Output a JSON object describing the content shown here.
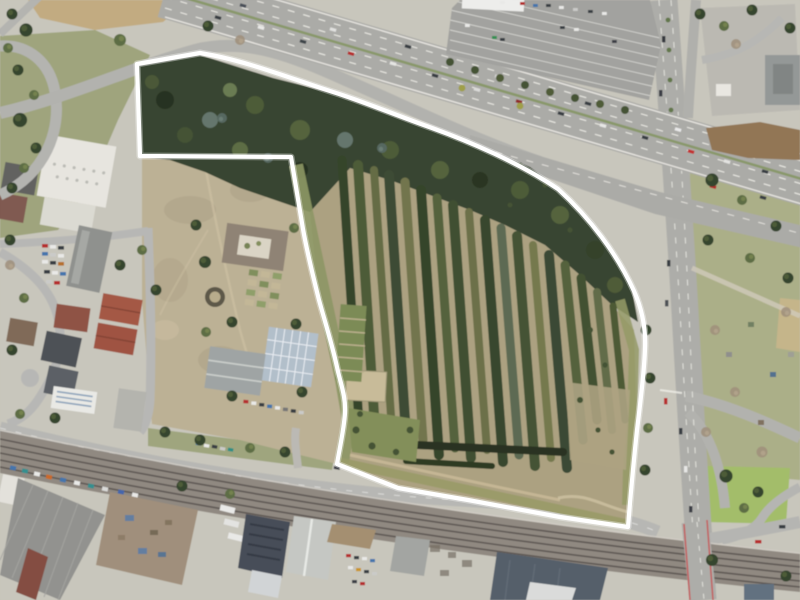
{
  "scene": {
    "type": "aerial-photograph",
    "description": "Aerial orthophoto of an urban development site outlined with a thick white boundary. Inside the boundary: a dense woodland strip along the north edge and long rows of a tree nursery. Excluded notch at the west contains a brownfield and a garden centre. A multi-lane highway crosses the top, a north-south arterial road with a railway overpass runs on the right, a multi-track railway crosses the bottom, and industrial buildings line the south edge.",
    "width": 800,
    "height": 600
  },
  "site_boundary": {
    "color": "#ffffff",
    "stroke_width": "4.2",
    "path": "M137,64 L200,53 C245,60 295,80 333,92 C365,102 398,116 432,128 C468,141 520,163 558,189 C590,218 617,254 634,291 C642,309 646,328 645,349 C644,376 640,405 637,430 C634,458 631,490 628,527 L560,517 L468,500 L398,488 L337,464 C340,446 344,429 345,413 C346,396 340,382 337,367 C332,344 325,322 319,300 C313,276 307,252 303,229 L291,157 L140,156 Z"
  },
  "palette": {
    "urban_ground": "#c6c3b9",
    "asphalt_highway": "#a7a7a3",
    "asphalt_street": "#b4b4b0",
    "lane_marking": "#efeee8",
    "woodland_dark": "#2f3c25",
    "nursery_row_dark": "#2c3a21",
    "nursery_soil": "#a89c7b",
    "brownfield_tan": "#b9ad90",
    "grass_green": "#8f9a66",
    "bright_grass": "#9fba62",
    "rail_ballast": "#8b837b",
    "rail_track": "#57514b",
    "pond_brown": "#8d6f4c",
    "red_roof": "#a0503c",
    "white_roof": "#e8e6e0",
    "dark_roof": "#4c5662",
    "bridge_railing_red": "#c05858"
  },
  "landmarks": [
    {
      "id": "site-boundary",
      "label": "white site boundary outline"
    },
    {
      "id": "highway",
      "label": "multi-lane highway crossing the top, diagonal"
    },
    {
      "id": "highway-ramp",
      "label": "curved slip road along the north site edge"
    },
    {
      "id": "arterial-road",
      "label": "north-south arterial with median trees and rail overpass"
    },
    {
      "id": "railway",
      "label": "multi-track railway crossing the lower area"
    },
    {
      "id": "street-north-of-railway",
      "label": "local street parallel to the railway"
    },
    {
      "id": "parking-lot",
      "label": "large marked parking lot, top centre"
    },
    {
      "id": "woodland",
      "label": "dense woodland strip inside the north boundary"
    },
    {
      "id": "tree-nursery",
      "label": "parallel tree-nursery rows inside the site"
    },
    {
      "id": "brownfield",
      "label": "bare brownfield in the excluded western notch"
    },
    {
      "id": "garden-centre",
      "label": "garden centre with greenhouses and courtyard building"
    },
    {
      "id": "industrial-buildings",
      "label": "warehouses and yards south of the railway"
    },
    {
      "id": "interchange-loop",
      "label": "looping ramp of interchange, far left"
    },
    {
      "id": "pond",
      "label": "brown pond / bare patch right of the interchange"
    },
    {
      "id": "allotments",
      "label": "allotment gardens with huts, lower right"
    }
  ]
}
